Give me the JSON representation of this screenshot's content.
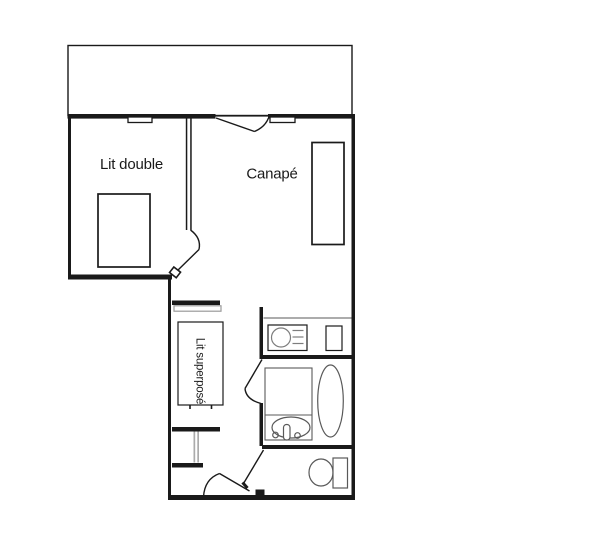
{
  "labels": {
    "bedroom": "Lit double",
    "living_room": "Canapé",
    "bunk_bed": "Lit superposé"
  },
  "colors": {
    "wall": "#1a1a1a",
    "fixture": "#595959",
    "fixture_light": "#7d7d7d",
    "shelf_outline": "#9a9a9a",
    "table_legs": "#ababab",
    "text": "#1a1a1a",
    "background": "#ffffff"
  }
}
